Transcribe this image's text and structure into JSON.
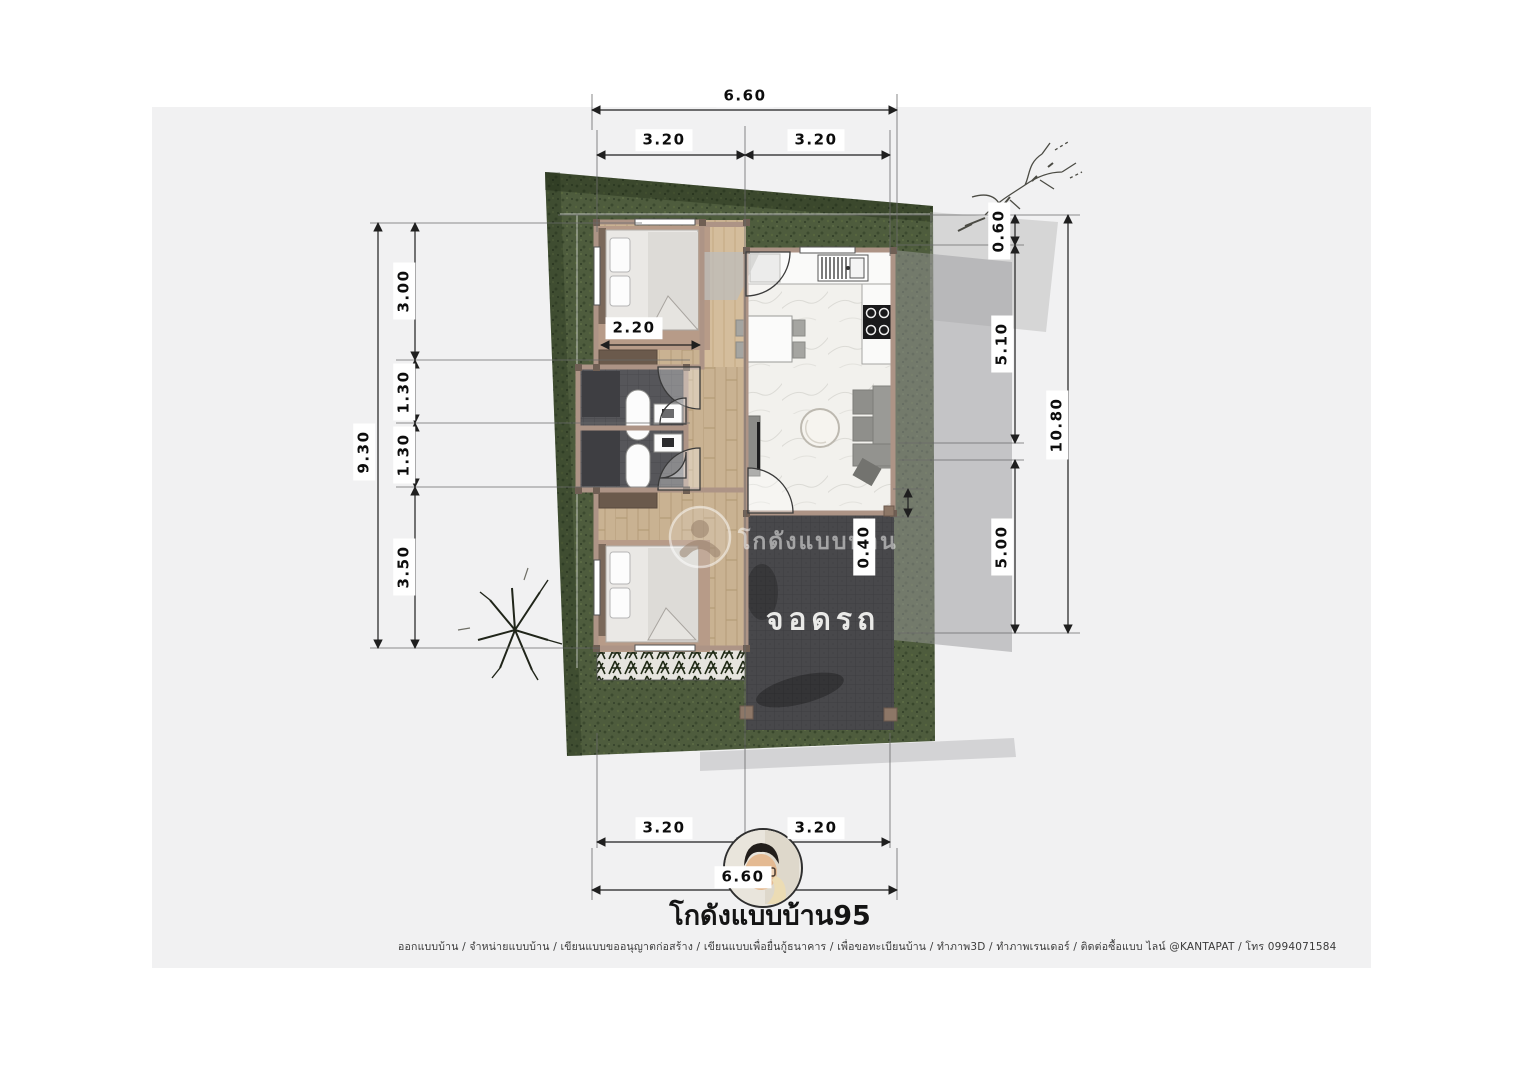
{
  "document": {
    "title": "โกดังแบบบ้าน95",
    "footer": "ออกแบบบ้าน / จำหน่ายแบบบ้าน / เขียนแบบขออนุญาตก่อสร้าง / เขียนแบบเพื่อยื่นกู้ธนาคาร / เพื่อขอทะเบียนบ้าน / ทำภาพ3D / ทำภาพเรนเดอร์ / ติดต่อซื้อแบบ ไลน์ @KANTAPAT / โทร 0994071584",
    "watermark": "โกดังแบบบ้าน"
  },
  "plan": {
    "rooms": {
      "parking": "จอดรถ"
    },
    "dimensions": {
      "top": {
        "total": "6.60",
        "left": "3.20",
        "right": "3.20"
      },
      "bottom": {
        "left": "3.20",
        "right": "3.20",
        "total": "6.60"
      },
      "left": {
        "total": "9.30",
        "seg1": "3.00",
        "seg2": "1.30",
        "seg3": "1.30",
        "seg4": "3.50"
      },
      "right": {
        "seg1": "0.60",
        "seg2": "5.10",
        "seg3": "5.00",
        "total": "10.80"
      },
      "interior": {
        "bedroom_width": "2.20",
        "carport_offset": "0.40"
      }
    }
  },
  "colors": {
    "paper": "#f1f1f2",
    "grass": "#4e5c3d",
    "wood": "#c9b292",
    "marble": "#f2f1ed",
    "wall": "#ad9486",
    "parking": "#48484b"
  }
}
